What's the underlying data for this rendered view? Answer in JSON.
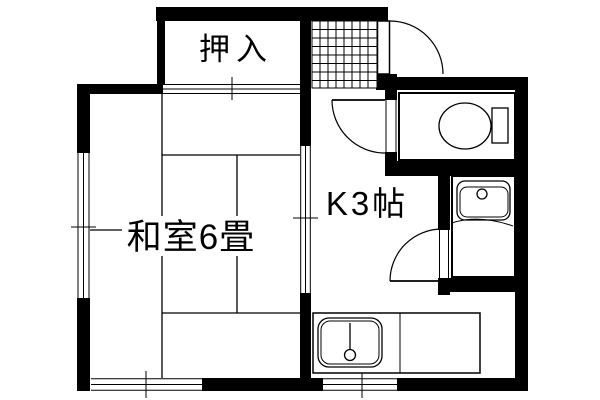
{
  "plan": {
    "background_color": "#ffffff",
    "wall_color": "#000000",
    "line_color": "#000000",
    "rooms": {
      "closet": {
        "label": "押入"
      },
      "japanese_room": {
        "label": "和室6畳"
      },
      "kitchen": {
        "label": "K3帖"
      }
    },
    "fixtures": {
      "toilet": "toilet-icon",
      "washbasin": "washbasin-icon",
      "kitchen_sink": "kitchen-sink-icon",
      "entry_tiles": "tile-grid-icon",
      "doors": [
        "entrance-swing-door",
        "toilet-swing-door",
        "washroom-swing-door"
      ],
      "sliding_partitions": [
        "closet-fusuma",
        "kitchen-room-slider"
      ],
      "windows": [
        "left-window",
        "bottom-left-window",
        "bottom-kitchen-window"
      ]
    }
  }
}
